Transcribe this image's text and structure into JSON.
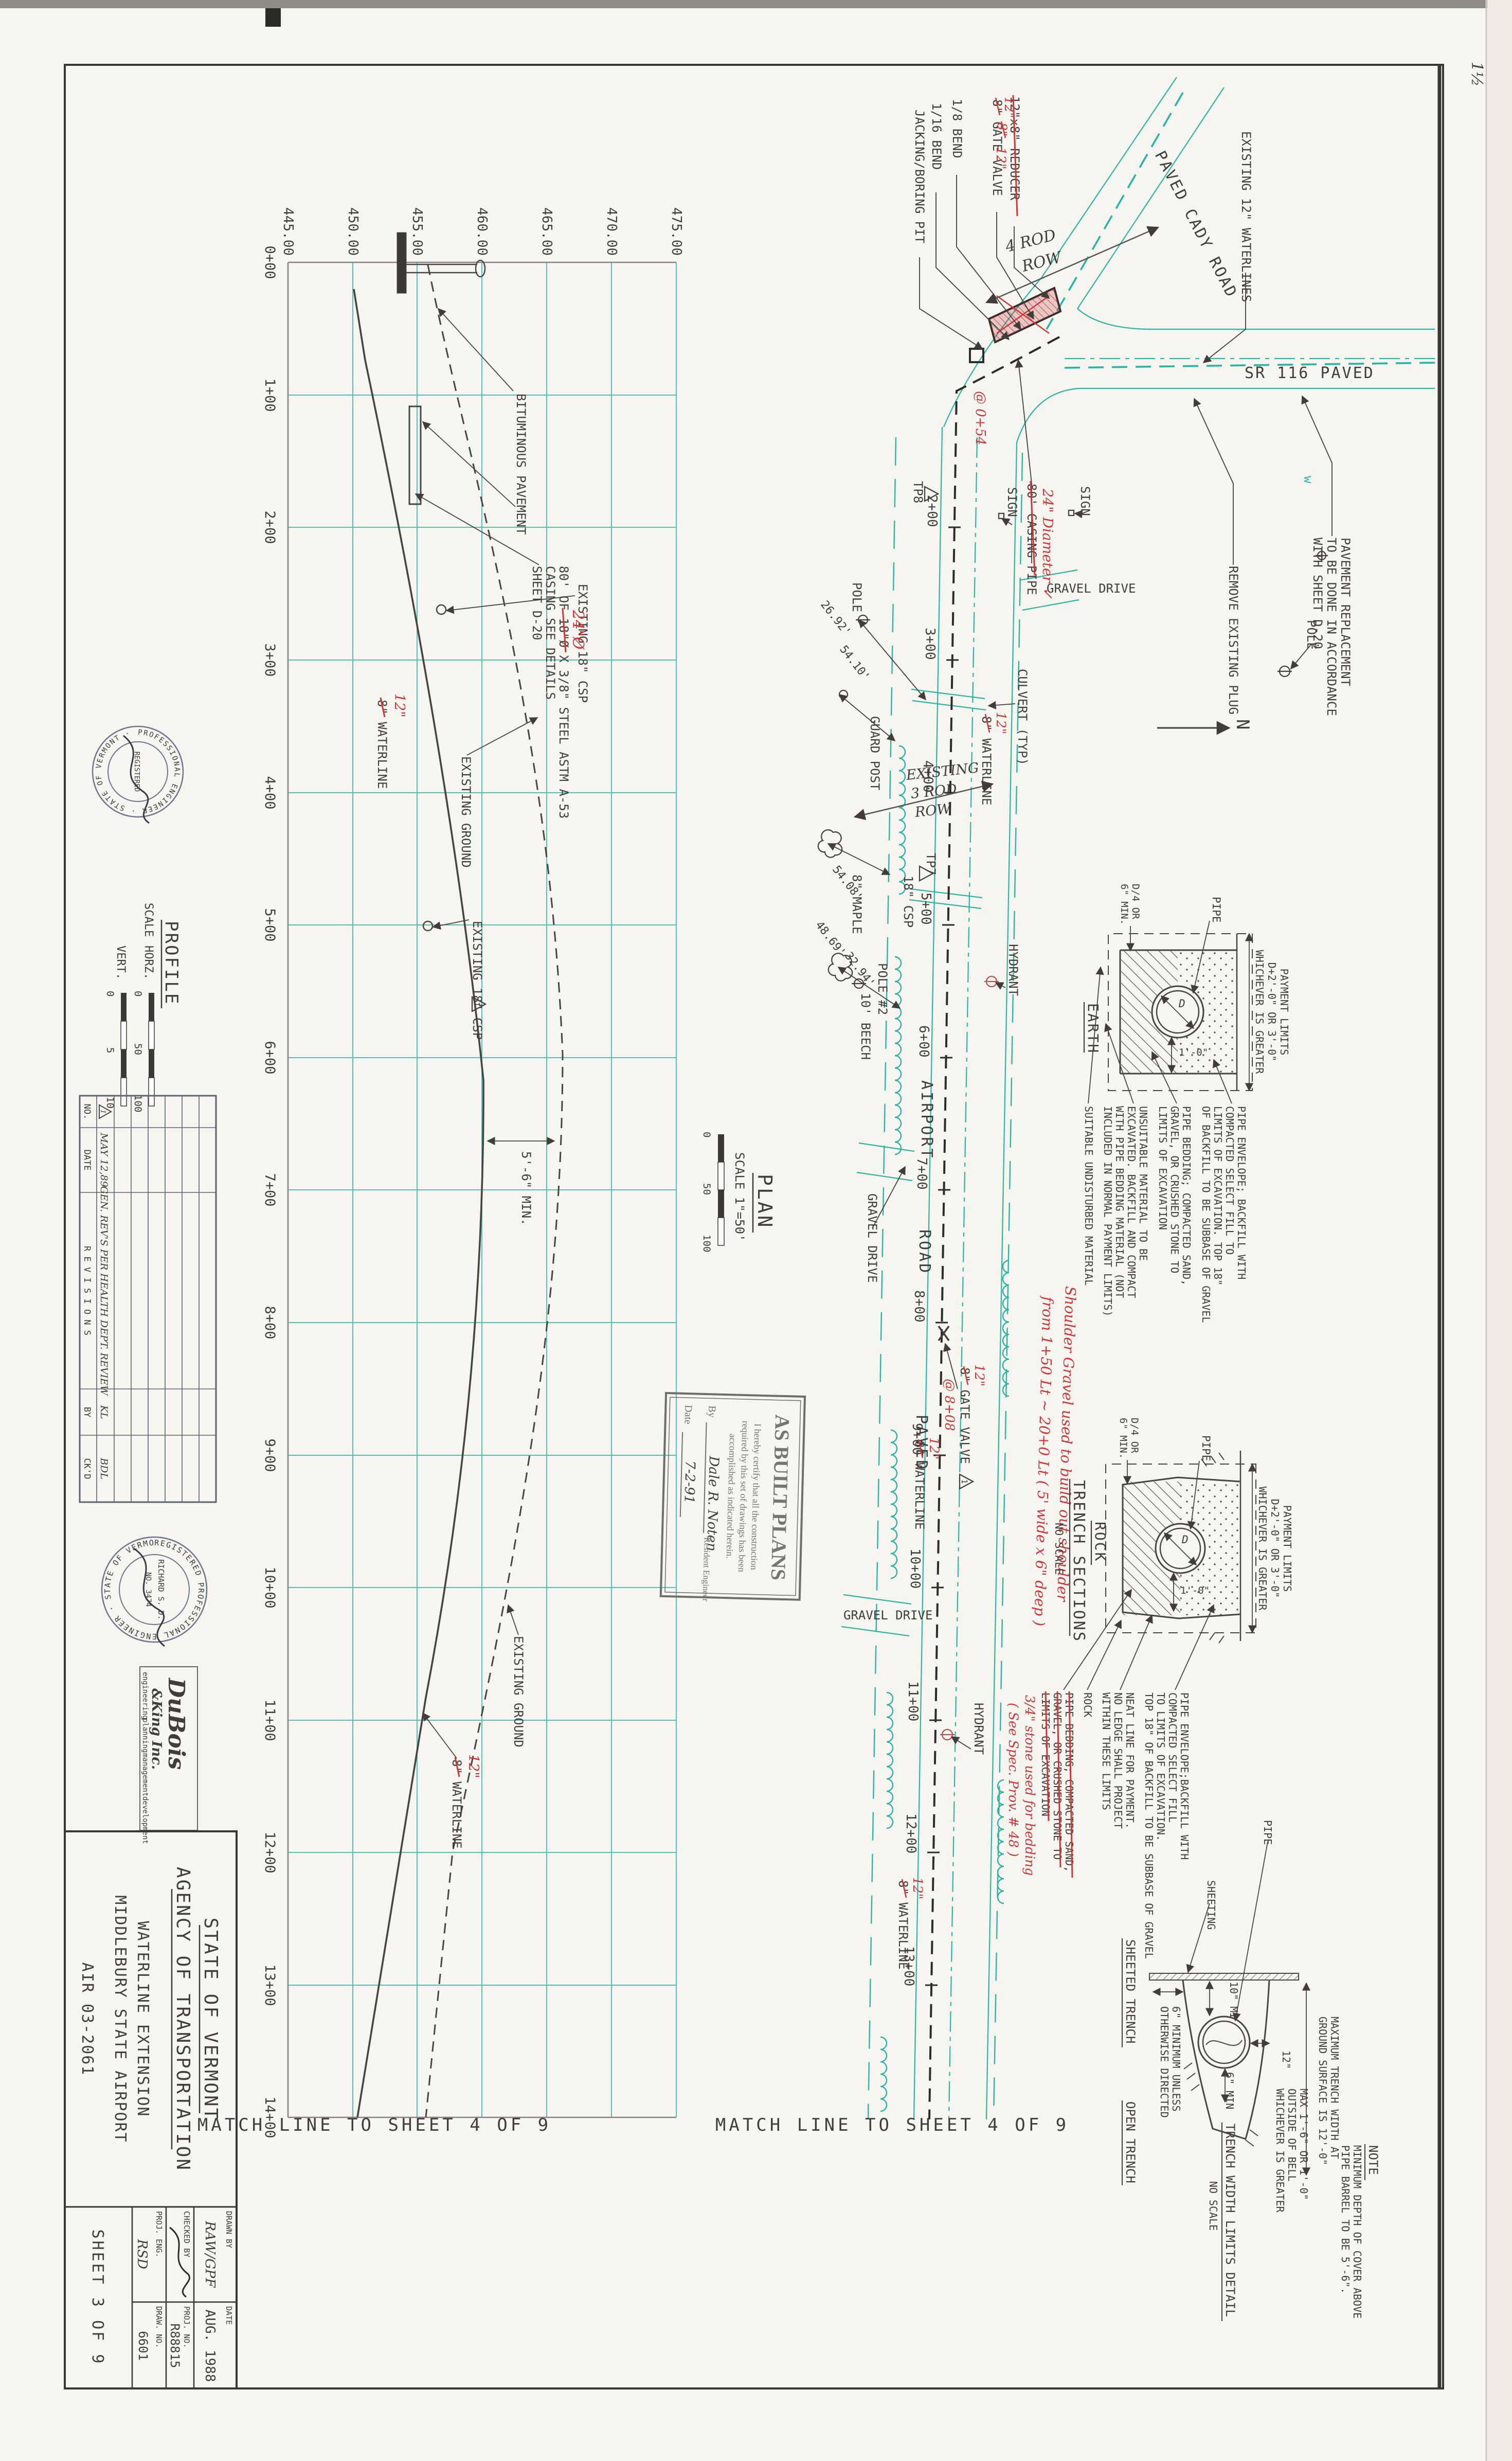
{
  "page": {
    "margin_note": "1½"
  },
  "matchline": {
    "left": "MATCH  LINE  TO  SHEET  4  OF  9",
    "right": "MATCH  LINE  TO  SHEET  4  OF  9"
  },
  "profile": {
    "title": "PROFILE",
    "scale_word": "SCALE",
    "horz": "HORZ.",
    "vert": "VERT.",
    "horz_ticks": [
      "0",
      "50",
      "100"
    ],
    "vert_ticks": [
      "0",
      "5",
      "10"
    ],
    "stations": [
      "0+00",
      "1+00",
      "2+00",
      "3+00",
      "4+00",
      "5+00",
      "6+00",
      "7+00",
      "8+00",
      "9+00",
      "10+00",
      "11+00",
      "12+00",
      "13+00",
      "14+00"
    ],
    "elevations": [
      "475.00",
      "470.00",
      "465.00",
      "460.00",
      "455.00",
      "450.00",
      "445.00"
    ],
    "bituminous": "BITUMINOUS PAVEMENT",
    "existing_csp_1": "EXISTING 18\" CSP",
    "existing_csp_2": "EXISTING 18\" CSP",
    "casing_1": "80' OF 18\"Ø X 3/8\" STEEL ASTM A-53",
    "casing_2": "CASING SEE DETAILS",
    "casing_3": "SHEET D-20",
    "waterline_1": "8\" WATERLINE",
    "waterline_2": "8\" WATERLINE",
    "ground_1": "EXISTING GROUND",
    "ground_2": "EXISTING GROUND",
    "min_cover": "5'-6\" MIN.",
    "red_casing_dia": "24\"Ø",
    "red_12_1": "12\"",
    "red_12_2": "12\""
  },
  "plan": {
    "title": "PLAN",
    "scale": "SCALE 1\"=50'",
    "scale_ticks": [
      "0",
      "50",
      "100"
    ],
    "stations": [
      "2+00",
      "3+00",
      "4+00",
      "5+00",
      "6+00",
      "7+00",
      "8+00",
      "9+00",
      "10+00",
      "11+00",
      "12+00",
      "13+00"
    ],
    "road": {
      "w1": "AIRPORT",
      "w2": "ROAD",
      "w3": "PAVED"
    },
    "sr116": "SR 116 PAVED",
    "cady": "PAVED CADY ROAD",
    "existing_12": "EXISTING 12\" WATERLINES",
    "jacking": "JACKING/BORING PIT",
    "bend16": "1/16 BEND",
    "bend8": "1/8 BEND",
    "reducer": "12\"x8\" REDUCER",
    "gate_valve": "8\" GATE VALVE",
    "gate_valve2": "8\" GATE VALVE",
    "pave1": "PAVEMENT REPLACEMENT",
    "pave2": "TO BE DONE IN ACCORDANCE",
    "pave3": "WITH SHEET D-20",
    "remove_plug": "REMOVE EXISTING PLUG",
    "pole_a": "POLE",
    "pole_b": "POLE",
    "pole_no2": "POLE #2",
    "sign_a": "SIGN",
    "sign_b": "SIGN",
    "casing80": "80' CASING PIPE",
    "tp8": "TP8",
    "tp7": "TP7",
    "culvert": "CULVERT (TYP)",
    "guard_post": "GUARD POST",
    "gravel_a": "GRAVEL DRIVE",
    "gravel_b": "GRAVEL DRIVE",
    "gravel_c": "GRAVEL DRIVE",
    "hydrant_a": "HYDRANT",
    "hydrant_b": "HYDRANT",
    "maple": "8\" MAPLE",
    "beech": "10' BEECH",
    "csp18": "18\" CSP",
    "wl_a": "8\" WATERLINE",
    "wl_b": "8\" WATERLINE",
    "wl_c": "8\" WATERLINE",
    "north": "N",
    "w_mark": "w",
    "rev_no": "1",
    "dims": {
      "d1": "54.10'",
      "d2": "26.92'",
      "d4": "48.69'",
      "d5": "32.94'",
      "d6": "54.08'"
    },
    "red": {
      "reducer_old": "8\"",
      "reducer_new": "12\"",
      "gv_at": "@ 0+54",
      "gv_new": "12\"",
      "casing_dia": "24\" Diameter ✓",
      "gv2_new": "12\"",
      "gv2_at": "@ 8+08",
      "wl12_a": "12\"",
      "wl12_b": "12\"",
      "wl12_c": "12\"",
      "shoulder1": "Shoulder Gravel used to build out shoulder",
      "shoulder2": "from 1+50 Lt ~ 20+0 Lt ( 5' wide x 6\" deep )"
    },
    "hand": {
      "rod4_1": "4 ROD",
      "rod4_2": "ROW",
      "rod3_1": "EXISTING",
      "rod3_2": "3 ROD",
      "rod3_3": "ROW"
    }
  },
  "details": {
    "sections_title": "TRENCH SECTIONS",
    "sections_scale": "NO SCALE",
    "earth": {
      "title": "EARTH",
      "pay1": "PAYMENT LIMITS",
      "pay2": "D+2'-0\" OR 3'-0\"",
      "pay3": "WHICHEVER IS GREATER",
      "pipe": "PIPE",
      "dim1": "1'-0\"",
      "dimd": "D",
      "d4a": "D/4 OR",
      "d4b": "6\" MIN.",
      "suitable": "SUITABLE UNDISTURBED MATERIAL",
      "unsuit1": "UNSUITABLE MATERIAL TO BE",
      "unsuit2": "EXCAVATED. BACKFILL AND COMPACT",
      "unsuit3": "WITH PIPE BEDDING MATERIAL (NOT",
      "unsuit4": "INCLUDED IN NORMAL PAYMENT LIMITS)",
      "bed1": "PIPE BEDDING; COMPACTED SAND,",
      "bed2": "GRAVEL, OR CRUSHED STONE TO",
      "bed3": "LIMITS OF EXCAVATION",
      "env1": "PIPE ENVELOPE; BACKFILL WITH",
      "env2": "COMPACTED SELECT FILL TO",
      "env3": "LIMITS OF EXCAVATION. TOP 18\"",
      "env4": "OF BACKFILL TO BE SUBBASE OF GRAVEL"
    },
    "rock": {
      "title": "ROCK",
      "pay1": "PAYMENT LIMITS",
      "pay2": "D+2'-0\" OR 3'-0\"",
      "pay3": "WHICHEVER IS GREATER",
      "pipe": "PIPE",
      "dim1": "1'-0\"",
      "dimd": "D",
      "d4a": "D/4 OR",
      "d4b": "6\" MIN.",
      "env1": "PIPE ENVELOPE;BACKFILL WITH",
      "env2": "COMPACTED SELECT FILL",
      "env3": "TO LIMITS OF EXCAVATION.",
      "env4": "TOP 18\" OF BACKFILL TO BE SUBBASE OF GRAVEL",
      "neat1": "NEAT LINE FOR PAYMENT.",
      "neat2": "NO LEDGE SHALL PROJECT",
      "neat3": "WITHIN THESE LIMITS",
      "rock_lbl": "ROCK",
      "bed1": "PIPE BEDDING; COMPACTED SAND,",
      "bed2": "GRAVEL, OR CRUSHED STONE TO",
      "bed3": "LIMITS OF EXCAVATION",
      "red1": "3/4\" stone used for bedding",
      "red2": "( See Spec. Prov. # 48 )"
    },
    "width": {
      "title": "TRENCH WIDTH LIMITS DETAIL",
      "scale": "NO SCALE",
      "sheeted": "SHEETED TRENCH",
      "open": "OPEN TRENCH",
      "sheeting": "SHEETING",
      "pipe": "PIPE",
      "min10": "10\" MIN",
      "min6": "6\" MIN",
      "d12": "12\"",
      "mu1": "6\" MINIMUM UNLESS",
      "mu2": "OTHERWISE DIRECTED",
      "mx1": "MAX 1'-6\" OR 1'-0\"",
      "mx2": "OUTSIDE OF BELL",
      "mx3": "WHICHEVER IS GREATER",
      "mw1": "MAXIMUM TRENCH WIDTH AT",
      "mw2": "GROUND SURFACE IS 12'-0\"",
      "note": "NOTE",
      "note1": "MINIMUM DEPTH OF COVER ABOVE",
      "note2": "PIPE BARREL TO BE 5'-6\"."
    }
  },
  "titleblock": {
    "state1": "STATE OF VERMONT",
    "state2": "AGENCY OF TRANSPORTATION",
    "proj1": "WATERLINE EXTENSION",
    "proj2": "MIDDLEBURY STATE AIRPORT",
    "air": "AIR 03-2061",
    "drawn_label": "DRAWN BY",
    "drawn": "RAW/GPF",
    "checked_label": "CHECKED BY",
    "proj_eng_label": "PROJ. ENG.",
    "proj_eng": "RSD",
    "date_label": "DATE",
    "date": "AUG. 1988",
    "projno_label": "PROJ. NO.",
    "projno": "R88815",
    "drawno_label": "DRAW. NO.",
    "drawno": "6601",
    "sheet": "SHEET 3 OF 9"
  },
  "firm": {
    "line1": "DuBois",
    "line2": "&King Inc.",
    "s1": "engineering",
    "s2": "planning",
    "s3": "management",
    "s4": "development"
  },
  "revisions": {
    "h_no": "NO.",
    "h_date": "DATE",
    "h_rev": "R E V I S I O N S",
    "h_by": "BY",
    "h_ck": "CK'D",
    "r1_no": "1",
    "r1_date": "MAY 12,89",
    "r1_desc": "GEN. REV'S PER HEALTH DEPT. REVIEW",
    "r1_by": "KL",
    "r1_ck": "BDL"
  },
  "stamps": {
    "asbuilt": {
      "title": "AS BUILT PLANS",
      "line1": "I hereby certify that all the construction",
      "line2": "required by this set of drawings has been",
      "line3": "accomplished as indicated herein.",
      "by_label": "By",
      "signature": "Dale R. Noten",
      "role": "Resident Engineer",
      "date_label": "Date",
      "date": "7-2-91"
    },
    "seal1": {
      "ring": "PROFESSIONAL ENGINEER · STATE OF VERMONT ·",
      "center1": "REGISTERED"
    },
    "seal2": {
      "ring": "REGISTERED PROFESSIONAL ENGINEER · STATE OF VERMONT",
      "center1": "RICHARD S. D.",
      "center2": "NO. 3474"
    }
  }
}
